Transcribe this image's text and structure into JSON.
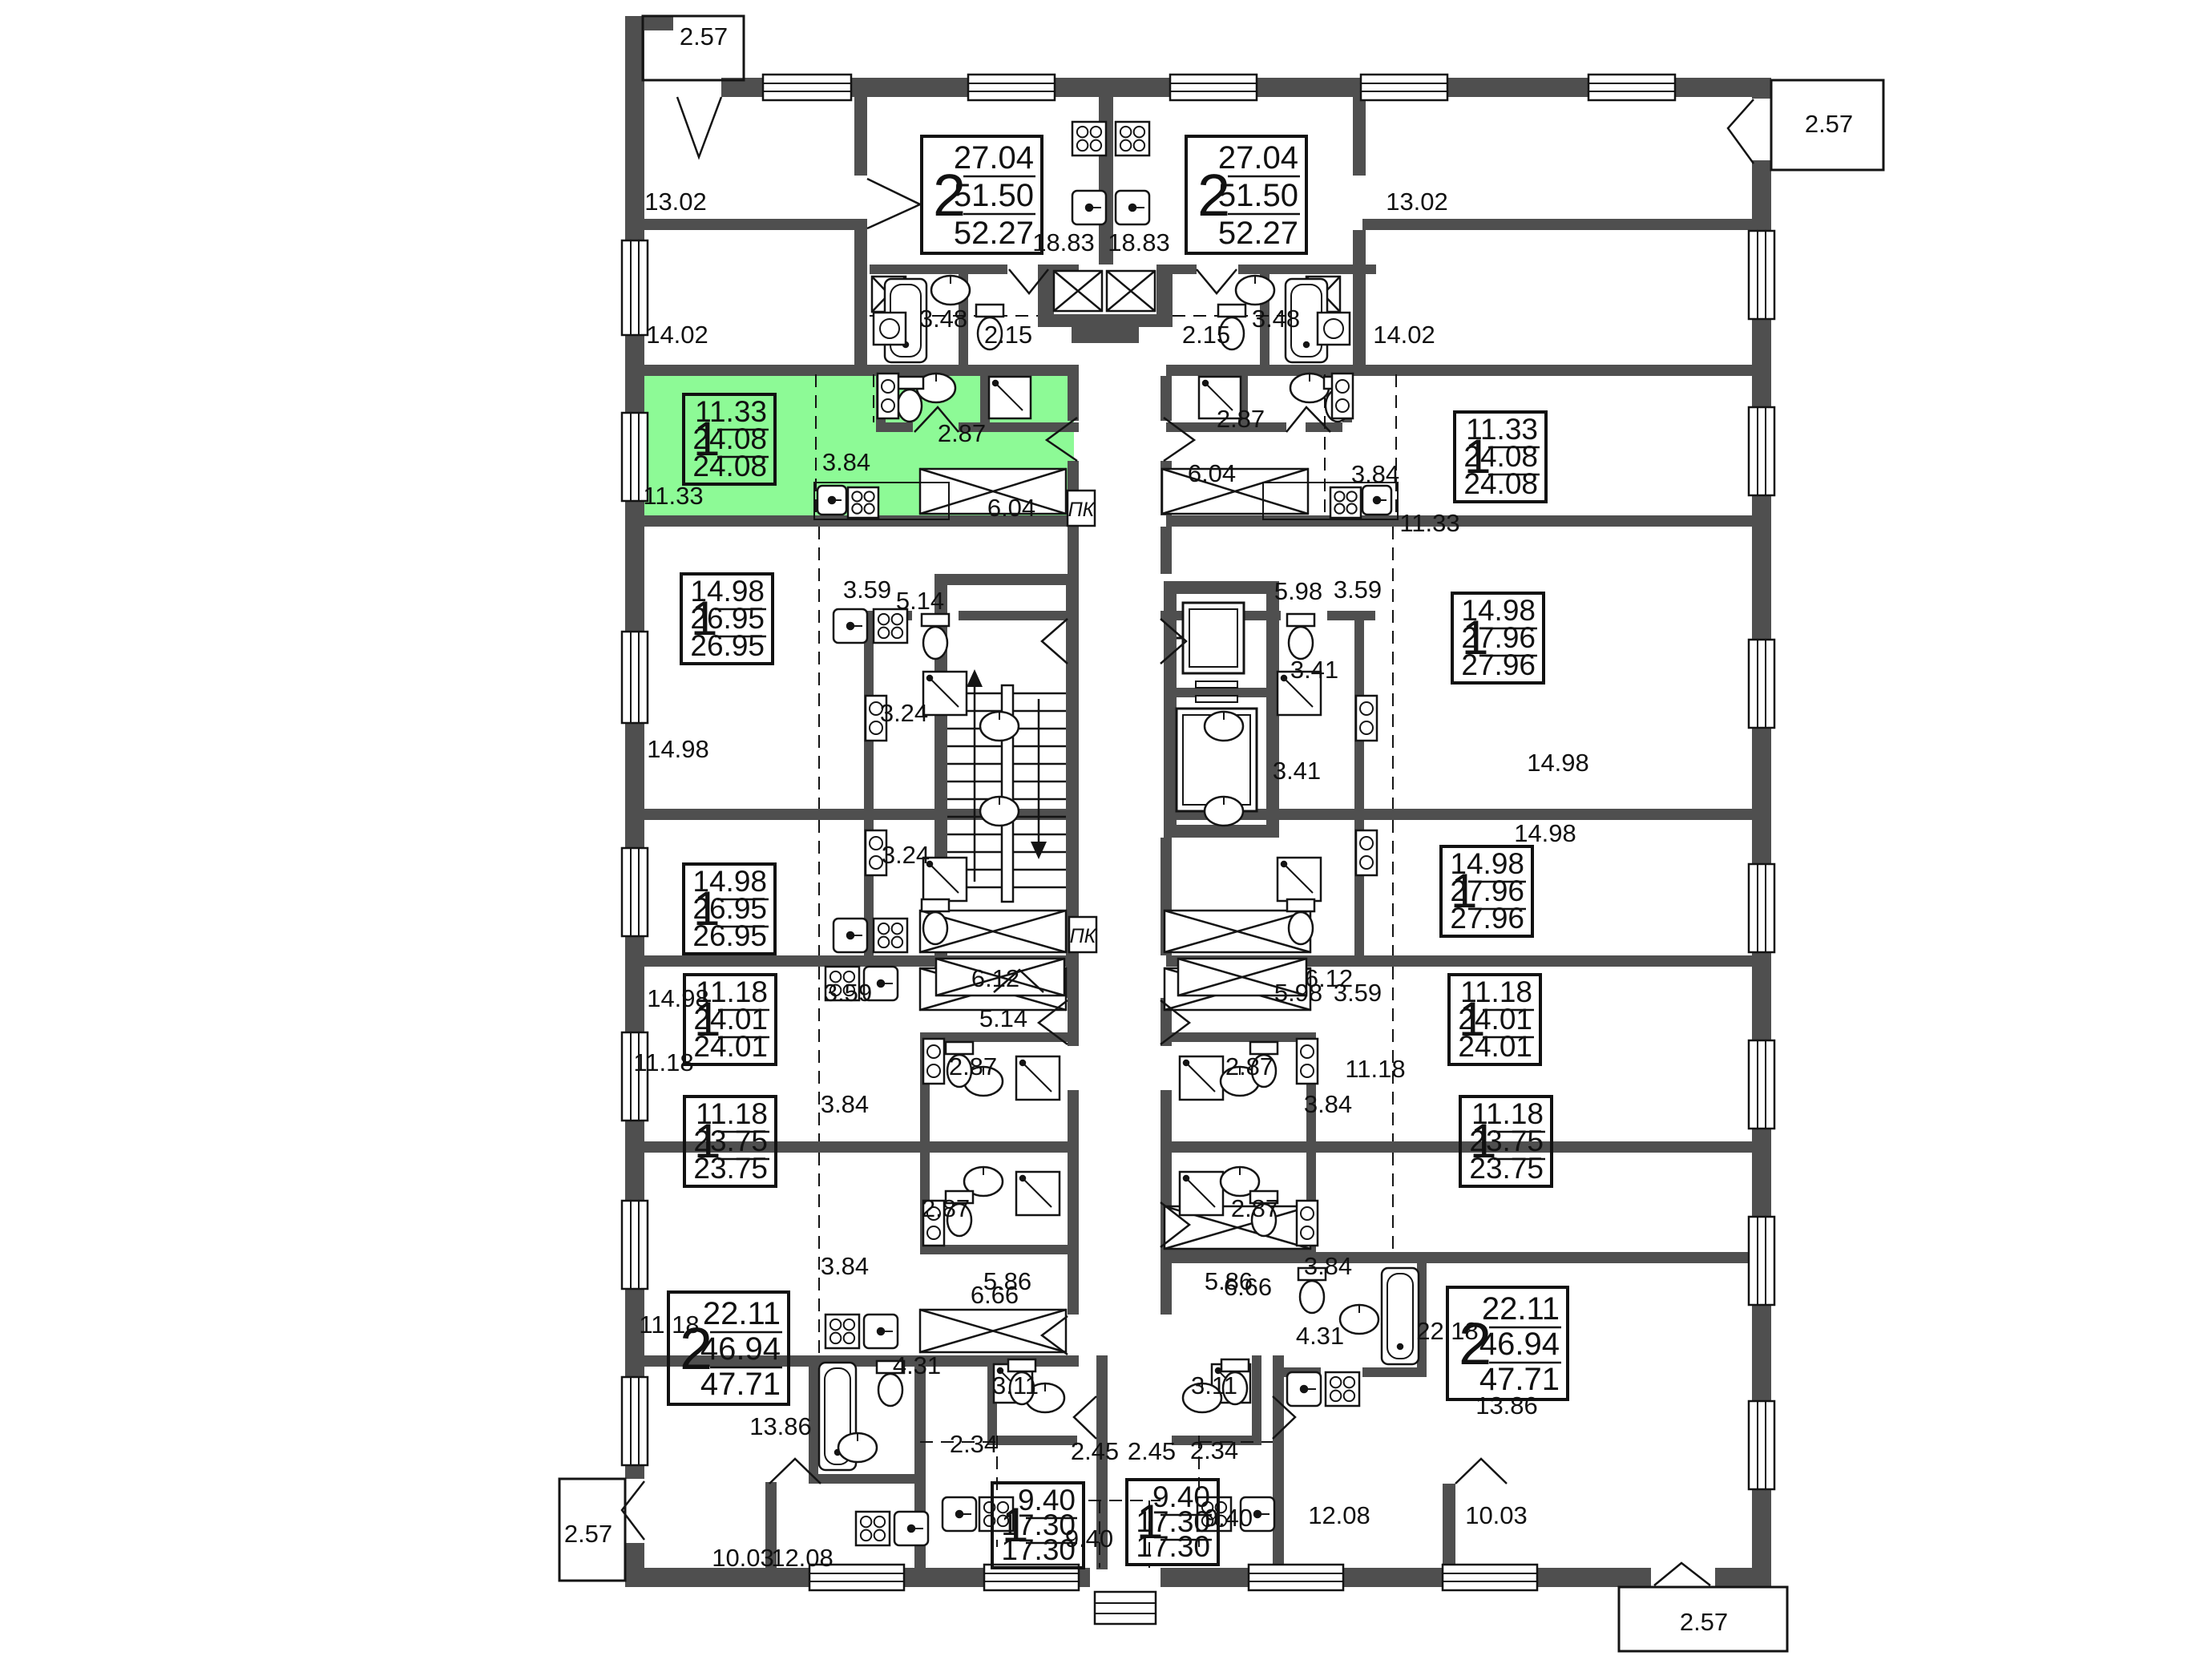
{
  "plan": {
    "type": "residential-floor-plan",
    "colors": {
      "wall": "#4f4f4f",
      "line": "#141414",
      "highlight": "#8dfa96",
      "background": "#ffffff"
    },
    "highlighted_apartment": {
      "rooms": "1",
      "living_area": "11.33",
      "area": "24.08",
      "total_area": "24.08"
    }
  },
  "apartments": [
    {
      "id": "top-left-2room",
      "rooms": "2",
      "living": "27.04",
      "area": "51.50",
      "total": "52.27",
      "highlighted": false
    },
    {
      "id": "top-right-2room",
      "rooms": "2",
      "living": "27.04",
      "area": "51.50",
      "total": "52.27",
      "highlighted": false
    },
    {
      "id": "studio-left-green",
      "rooms": "1",
      "living": "11.33",
      "area": "24.08",
      "total": "24.08",
      "highlighted": true
    },
    {
      "id": "studio-right",
      "rooms": "1",
      "living": "11.33",
      "area": "24.08",
      "total": "24.08",
      "highlighted": false
    },
    {
      "id": "left-26.95-a",
      "rooms": "1",
      "living": "14.98",
      "area": "26.95",
      "total": "26.95",
      "highlighted": false
    },
    {
      "id": "left-26.95-b",
      "rooms": "1",
      "living": "14.98",
      "area": "26.95",
      "total": "26.95",
      "highlighted": false
    },
    {
      "id": "right-27.96-a",
      "rooms": "1",
      "living": "14.98",
      "area": "27.96",
      "total": "27.96",
      "highlighted": false
    },
    {
      "id": "right-27.96-b",
      "rooms": "1",
      "living": "14.98",
      "area": "27.96",
      "total": "27.96",
      "highlighted": false
    },
    {
      "id": "left-24.01",
      "rooms": "1",
      "living": "11.18",
      "area": "24.01",
      "total": "24.01",
      "highlighted": false
    },
    {
      "id": "right-24.01",
      "rooms": "1",
      "living": "11.18",
      "area": "24.01",
      "total": "24.01",
      "highlighted": false
    },
    {
      "id": "left-23.75",
      "rooms": "1",
      "living": "11.18",
      "area": "23.75",
      "total": "23.75",
      "highlighted": false
    },
    {
      "id": "right-23.75",
      "rooms": "1",
      "living": "11.18",
      "area": "23.75",
      "total": "23.75",
      "highlighted": false
    },
    {
      "id": "bottom-left-2room",
      "rooms": "2",
      "living": "22.11",
      "area": "46.94",
      "total": "47.71",
      "highlighted": false
    },
    {
      "id": "bottom-right-2room",
      "rooms": "2",
      "living": "22.11",
      "area": "46.94",
      "total": "47.71",
      "highlighted": false
    },
    {
      "id": "bottom-center-left",
      "rooms": "1",
      "living": "9.40",
      "area": "17.30",
      "total": "17.30",
      "highlighted": false
    },
    {
      "id": "bottom-center-right",
      "rooms": "1",
      "living": "9.40",
      "area": "17.30",
      "total": "17.30",
      "highlighted": false
    }
  ],
  "dims": [
    "2.57",
    "13.02",
    "14.02",
    "18.83",
    "18.83",
    "2.15",
    "2.15",
    "3.48",
    "3.48",
    "13.02",
    "14.02",
    "2.57",
    "2.87",
    "2.87",
    "6.04",
    "6.04",
    "3.84",
    "3.84",
    "11.33",
    "11.33",
    "3.59",
    "5.14",
    "5.98",
    "3.59",
    "3.24",
    "3.41",
    "14.98",
    "14.98",
    "3.24",
    "3.41",
    "14.98",
    "14.98",
    "5.14",
    "3.59",
    "5.98",
    "3.59",
    "6.12",
    "6.12",
    "11.18",
    "11.18",
    "3.84",
    "3.84",
    "2.87",
    "2.87",
    "2.87",
    "2.87",
    "3.84",
    "3.84",
    "5.86",
    "5.86",
    "11.18",
    "22.18",
    "13.86",
    "13.86",
    "6.66",
    "6.66",
    "4.31",
    "4.31",
    "3.11",
    "3.11",
    "2.45",
    "2.45",
    "2.34",
    "2.34",
    "9.40",
    "9.40",
    "10.03",
    "12.08",
    "12.08",
    "10.03",
    "2.57",
    "2.57",
    "ПК",
    "ПК"
  ]
}
